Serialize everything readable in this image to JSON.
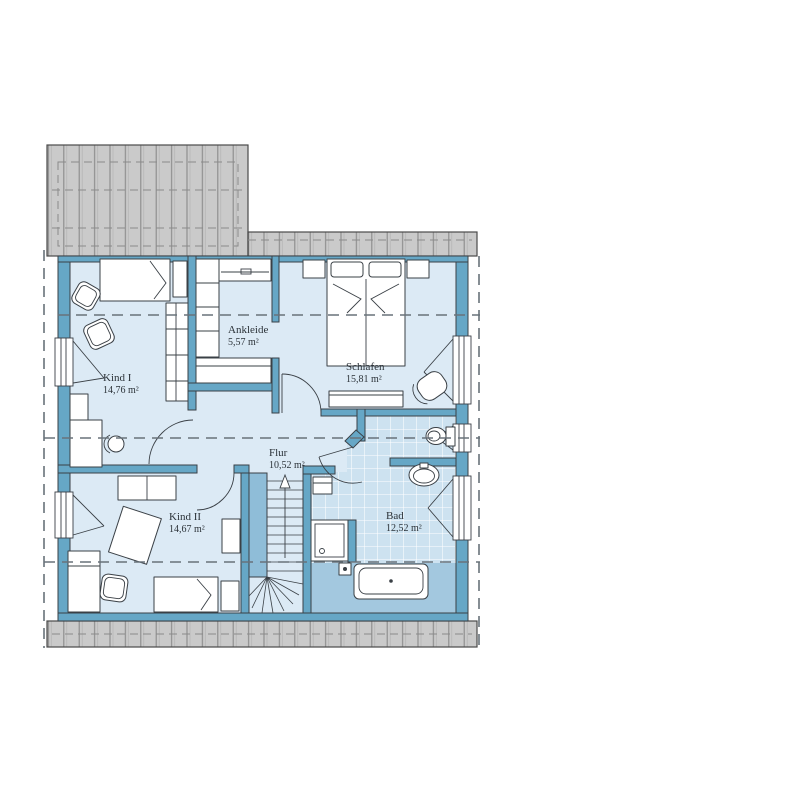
{
  "palette": {
    "wall": "#66a7c6",
    "outline": "#3a4046",
    "floor": "#dceaf5",
    "tiles": "#cde2f0",
    "tile_grid": "#ffffff",
    "wet_floor": "#a3c8df",
    "stair_void": "#8fbdd8",
    "roof_fill": "#cacaca",
    "roof_line": "#8a8a8a",
    "roof_outline": "#4a4a4a",
    "dashed": "#68727a",
    "text": "#2b3238"
  },
  "rooms": [
    {
      "name": "Kind I",
      "area": "14,76 m²"
    },
    {
      "name": "Ankleide",
      "area": "5,57 m²"
    },
    {
      "name": "Schlafen",
      "area": "15,81 m²"
    },
    {
      "name": "Flur",
      "area": "10,52 m²"
    },
    {
      "name": "Kind II",
      "area": "14,67 m²"
    },
    {
      "name": "Bad",
      "area": "12,52 m²"
    }
  ],
  "icons": {
    "stairs_up_arrow": "up-arrow"
  }
}
